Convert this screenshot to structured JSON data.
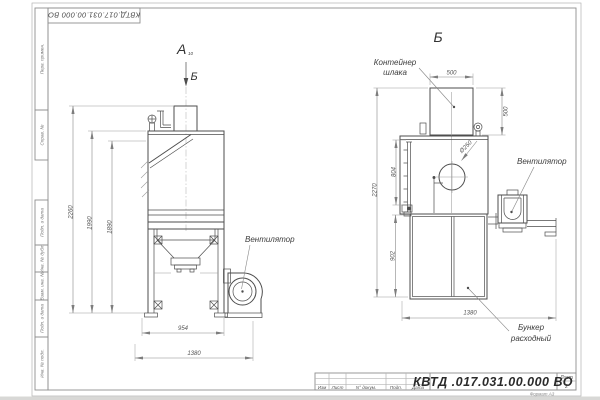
{
  "frame": {
    "top_designation": "КВТД.017.031.00.000  ВО",
    "side_top": [
      "Перв. примен.",
      "Справ. №"
    ],
    "side_bottom": [
      "Подп. и дата",
      "Инв. № дубл.",
      "Взам. инв. №",
      "Подп. и дата",
      "Инв. № подл."
    ]
  },
  "title": {
    "designation": "КВТД .017.031.00.000  ВО",
    "sheet_label": "Лист",
    "sheet_number": "2",
    "format": "Формат А3",
    "columns": [
      "Изм",
      "Лист",
      "N° докум.",
      "Подп.",
      "Дата"
    ]
  },
  "views": {
    "left": {
      "label": "А",
      "label_sub": "10",
      "arrow_label": "Б",
      "fan_label": "Вентилятор",
      "dims": {
        "h_total": "2260",
        "h_body": "1990",
        "h_hood": "1890",
        "w_frame": "954",
        "w_total": "1380"
      }
    },
    "right": {
      "label": "Б",
      "container_line1": "Контейнер",
      "container_line2": "шлака",
      "fan_label": "Вентилятор",
      "bunker_line1": "Бункер",
      "bunker_line2": "расходный",
      "dims": {
        "container_w": "500",
        "container_h": "500",
        "h_total": "2270",
        "ladder": "804",
        "bunker_h": "902",
        "w_total": "1380",
        "inlet_d": "Ø250"
      }
    }
  }
}
